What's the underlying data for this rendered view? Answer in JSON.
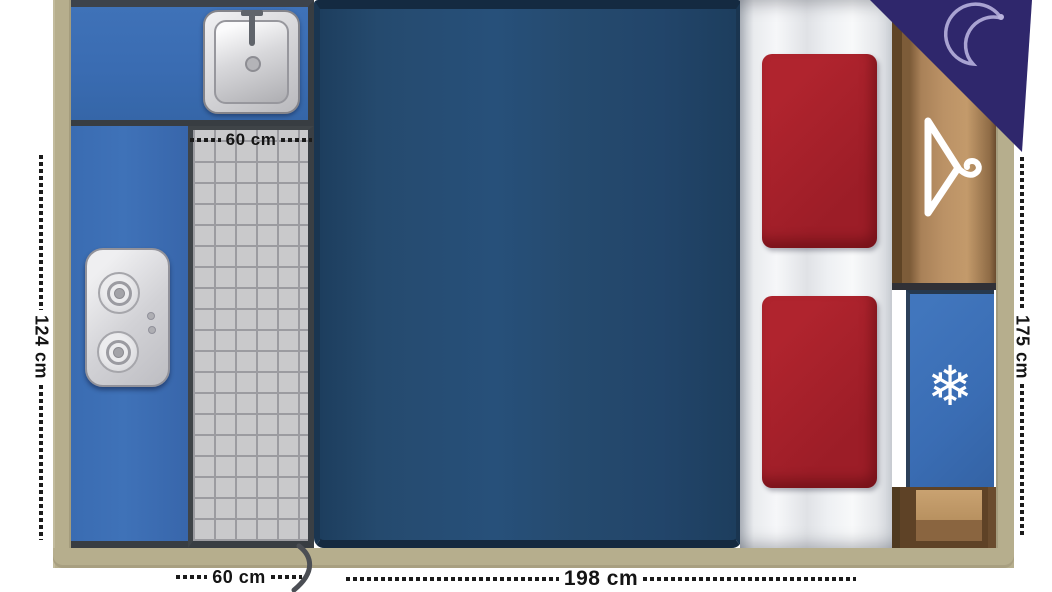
{
  "floorplan": {
    "labels": {
      "shower_width_top": "60 cm",
      "shower_width_bottom": "60 cm",
      "kitchen_depth": "124 cm",
      "bed_width": "198 cm",
      "right_depth": "175 cm"
    },
    "icons": {
      "snowflake": "❄",
      "moon": "crescent-moon",
      "hanger": "clothes-hanger"
    },
    "colors": {
      "wall_tan": "#b6ae8d",
      "counter_blue": "#3a6cb2",
      "bed_navy": "#254a6e",
      "cushion_red": "#a5222c",
      "bench_white": "#f2f3f5",
      "wood_brown": "#b48e60",
      "tile_gray": "#c9c9cb",
      "fridge_blue": "#3a6db4",
      "night_purple": "#2f276c"
    }
  }
}
